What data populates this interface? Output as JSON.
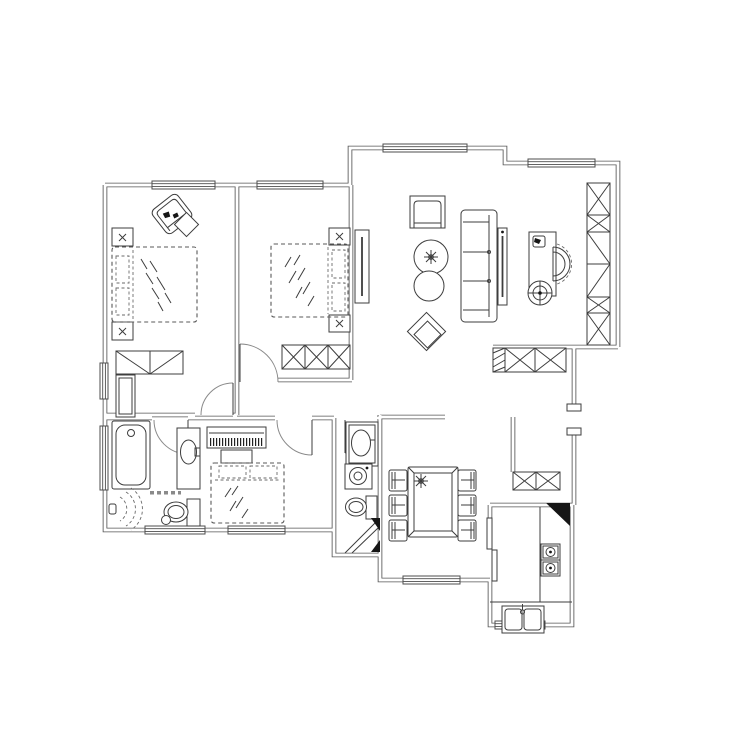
{
  "meta": {
    "type": "floor-plan",
    "label": "residential apartment floor plan, CAD line drawing, top view",
    "canvas": {
      "width": 740,
      "height": 740
    },
    "background": "#ffffff"
  },
  "style": {
    "wall_color": "#555555",
    "furniture_color": "#3d3d3d",
    "dashed_bed_color": "#5a5a5a",
    "door_arc_color": "#8a8a8a",
    "column_fill": "#161616",
    "paper": "#ffffff"
  },
  "rooms": [
    {
      "name": "bedroom-master",
      "furniture": [
        "double-bed",
        "nightstand",
        "nightstand",
        "armchair",
        "side-table",
        "dresser",
        "tall-cabinet"
      ],
      "windows": [
        "top-wall",
        "left-wall"
      ]
    },
    {
      "name": "bedroom-second",
      "furniture": [
        "double-bed",
        "nightstand",
        "nightstand",
        "wardrobe-3-door"
      ],
      "windows": [
        "top-wall"
      ]
    },
    {
      "name": "living-room",
      "furniture": [
        "tv-panel",
        "armchair",
        "round-plant-table",
        "round-side-table",
        "diamond-lounge-chair",
        "three-seat-sofa",
        "screen-panel",
        "desk",
        "desk-chair",
        "desk-phone",
        "fan",
        "bookshelf-column"
      ],
      "windows": [
        "top-wall",
        "top-right-wall"
      ]
    },
    {
      "name": "foyer",
      "furniture": [
        "shoe-cabinet-hatched",
        "low-cabinet-x"
      ],
      "features": [
        "entry-door-frame"
      ]
    },
    {
      "name": "bathroom-main",
      "furniture": [
        "bathtub",
        "vanity-sink",
        "toilet",
        "shower-head"
      ],
      "windows": [
        "left-wall",
        "bottom-wall"
      ],
      "annotation": {
        "present": true,
        "legible": false
      }
    },
    {
      "name": "bedroom-third",
      "furniture": [
        "piano",
        "piano-bench",
        "double-bed"
      ],
      "windows": [
        "bottom-wall"
      ]
    },
    {
      "name": "bathroom-second",
      "furniture": [
        "vanity-sink",
        "washing-machine",
        "toilet",
        "shower-corner"
      ]
    },
    {
      "name": "dining-room",
      "furniture": [
        "dining-table",
        "table-plant",
        "chair",
        "chair",
        "chair",
        "chair",
        "chair",
        "chair"
      ],
      "windows": [
        "bottom-wall"
      ]
    },
    {
      "name": "kitchen",
      "furniture": [
        "counter-l-shape",
        "double-sink",
        "two-burner-stove",
        "sliding-door",
        "corner-column"
      ],
      "windows": [
        "bottom-wall"
      ]
    }
  ],
  "doors": [
    {
      "room": "bedroom-master",
      "type": "swing"
    },
    {
      "room": "bedroom-second",
      "type": "swing"
    },
    {
      "room": "bathroom-main",
      "type": "swing"
    },
    {
      "room": "bedroom-third",
      "type": "swing"
    },
    {
      "room": "bathroom-second",
      "type": "swing"
    },
    {
      "room": "kitchen",
      "type": "sliding"
    },
    {
      "room": "foyer",
      "type": "entry-opening"
    }
  ]
}
